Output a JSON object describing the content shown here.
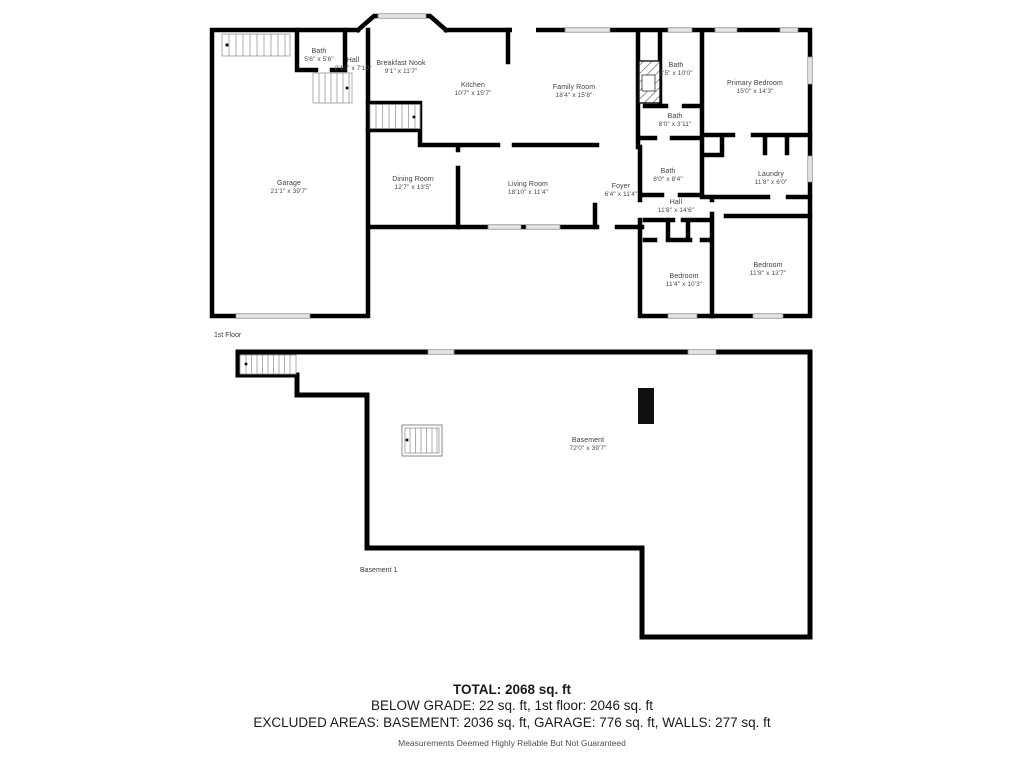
{
  "colors": {
    "wall": "#000000",
    "window_fill": "#e3e3e3",
    "label_text": "#3f3f3f",
    "summary_text": "#1a1a1a",
    "disclaimer_text": "#4f4f4f",
    "background": "#ffffff"
  },
  "floor1": {
    "label": "1st Floor",
    "rooms": {
      "bath1": {
        "name": "Bath",
        "dims": "5'6\" x 5'6\""
      },
      "hall1": {
        "name": "Hall",
        "dims": "2'10\" x 7'10\""
      },
      "breakfast_nook": {
        "name": "Breakfast Nook",
        "dims": "9'1\" x 11'7\""
      },
      "kitchen": {
        "name": "Kitchen",
        "dims": "10'7\" x 15'7\""
      },
      "family_room": {
        "name": "Family Room",
        "dims": "18'4\" x 15'8\""
      },
      "bath2": {
        "name": "Bath",
        "dims": "3'5\" x 10'0\""
      },
      "primary_bedroom": {
        "name": "Primary Bedroom",
        "dims": "15'0\" x 14'3\""
      },
      "bath3": {
        "name": "Bath",
        "dims": "8'0\" x 3'11\""
      },
      "garage": {
        "name": "Garage",
        "dims": "21'1\" x 39'7\""
      },
      "dining_room": {
        "name": "Dining Room",
        "dims": "12'7\" x 13'5\""
      },
      "living_room": {
        "name": "Living Room",
        "dims": "18'10\" x 11'4\""
      },
      "foyer": {
        "name": "Foyer",
        "dims": "6'4\" x 11'4\""
      },
      "bath4": {
        "name": "Bath",
        "dims": "8'0\" x 8'4\""
      },
      "laundry": {
        "name": "Laundry",
        "dims": "11'8\" x 6'0\""
      },
      "hall2": {
        "name": "Hall",
        "dims": "11'8\" x 14'6\""
      },
      "bedroom1": {
        "name": "Bedroom",
        "dims": "11'4\" x 10'3\""
      },
      "bedroom2": {
        "name": "Bedroom",
        "dims": "11'8\" x 13'7\""
      }
    }
  },
  "basement": {
    "label": "Basement 1",
    "rooms": {
      "basement": {
        "name": "Basement",
        "dims": "72'0\" x 39'7\""
      }
    }
  },
  "summary": {
    "total": "TOTAL: 2068 sq. ft",
    "below_grade_line": "BELOW GRADE: 22 sq. ft, 1st floor: 2046 sq. ft",
    "excluded_line": "EXCLUDED AREAS: BASEMENT: 2036 sq. ft, GARAGE: 776 sq. ft, WALLS: 277 sq. ft",
    "disclaimer": "Measurements Deemed Highly Reliable But Not Guaranteed"
  }
}
